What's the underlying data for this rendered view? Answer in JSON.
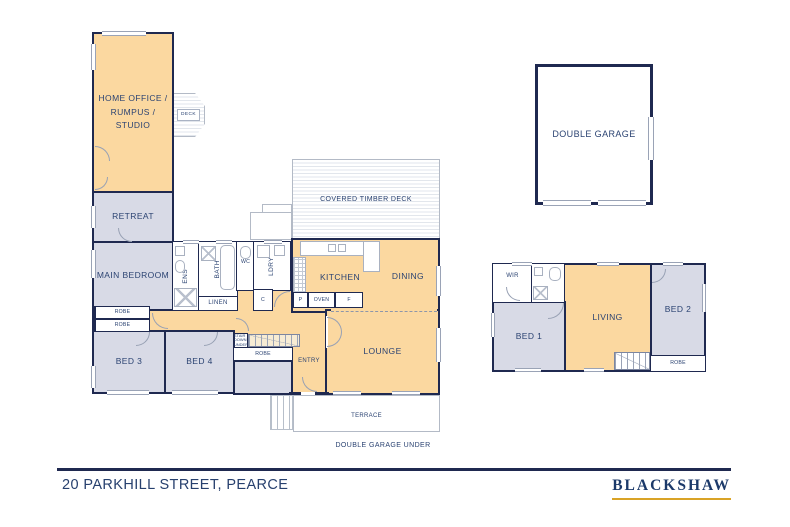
{
  "colors": {
    "wall_navy": "#1f2950",
    "room_orange": "#fbd8a0",
    "room_lavender": "#d8dae6",
    "label_navy": "#2b4372",
    "line_gray": "#9aa3b6",
    "brand_gold": "#d9a326"
  },
  "labels": {
    "home_office": "HOME OFFICE /\nRUMPUS /\nSTUDIO",
    "deck": "DECK",
    "retreat": "RETREAT",
    "main_bedroom": "MAIN BEDROOM",
    "ens": "ENS",
    "bath": "BATH",
    "wc": "WC",
    "linen": "LINEN",
    "ldry": "LDRY",
    "cupboard": "C",
    "pantry": "P",
    "oven": "OVEN",
    "fridge": "F",
    "robe": "ROBE",
    "bed3": "BED 3",
    "bed4": "BED 4",
    "kitchen": "KITCHEN",
    "dining": "DINING",
    "lounge": "LOUNGE",
    "covered_deck": "COVERED TIMBER DECK",
    "entry": "ENTRY",
    "terrace": "TERRACE",
    "garage_under": "DOUBLE GARAGE UNDER",
    "stair_note": "STAIR\nDOWN\nUNDER",
    "double_garage": "DOUBLE GARAGE",
    "wir": "WIR",
    "bed1": "BED 1",
    "bed2": "BED 2",
    "living": "LIVING"
  },
  "footer": {
    "address": "20 PARKHILL STREET, PEARCE",
    "brand": "BLACKSHAW"
  }
}
